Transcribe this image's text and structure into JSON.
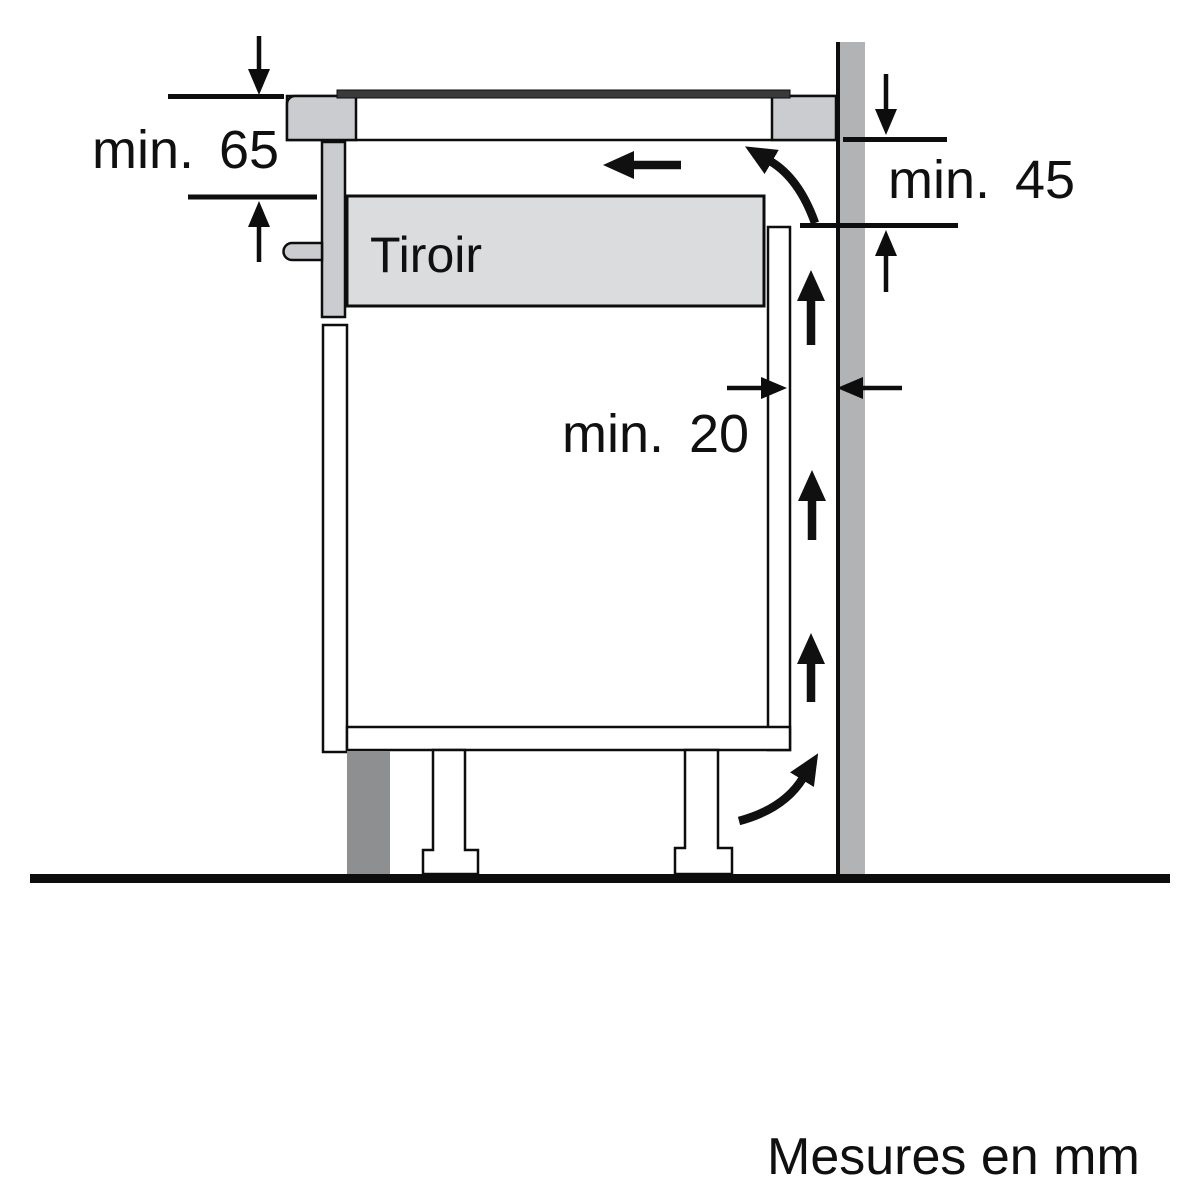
{
  "diagram": {
    "type": "appliance-installation-clearance-side-view",
    "drawer_label": "Tiroir",
    "unit_note": "Mesures en mm",
    "dimensions": [
      {
        "id": "hob-top-to-drawer",
        "label": "min. 65",
        "value_mm": 65
      },
      {
        "id": "hob-bottom-to-cutout",
        "label": "min. 45",
        "value_mm": 45
      },
      {
        "id": "cabinet-to-wall-air-gap",
        "label": "min. 20",
        "value_mm": 20
      }
    ]
  },
  "colors": {
    "background": "#ffffff",
    "line": "#0d0d0d",
    "wall": "#b1b3b5",
    "panel_gray": "#cacccf",
    "drawer_box": "#dbdcde",
    "plinth": "#8d8f91",
    "glass": "#3a3a3c"
  }
}
